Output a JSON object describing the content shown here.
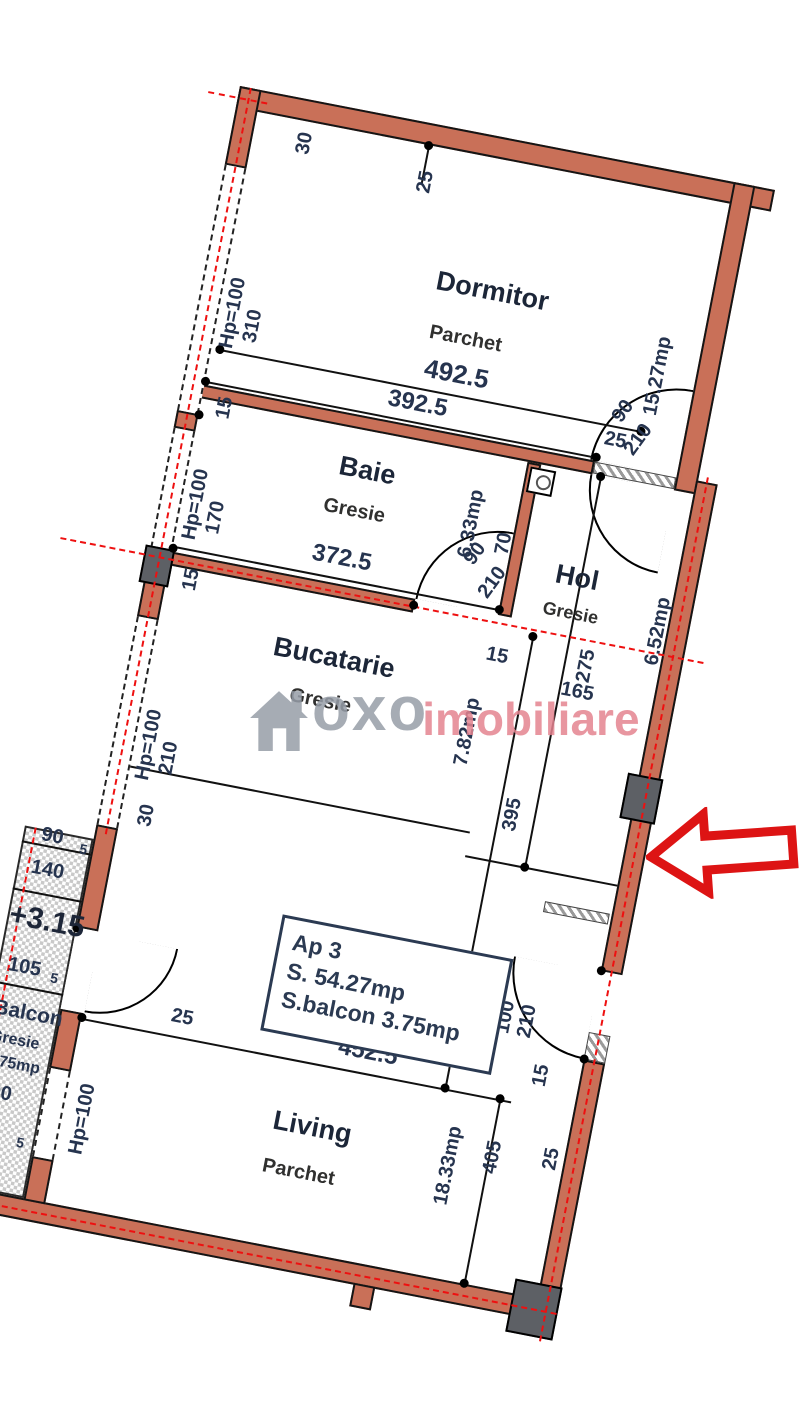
{
  "watermark": {
    "brand": "oxo",
    "suffix": "imobiliare"
  },
  "info_box": {
    "apartment": "Ap 3",
    "surface": "S.  54.27mp",
    "balcony_surface": "S.balcon  3.75mp"
  },
  "rooms": {
    "dormitor": {
      "name": "Dormitor",
      "floor": "Parchet",
      "area": "15.27mp"
    },
    "baie": {
      "name": "Baie",
      "floor": "Gresie",
      "area": "6.33mp"
    },
    "hol": {
      "name": "Hol",
      "floor": "Gresie",
      "area": "6.52mp"
    },
    "bucatarie": {
      "name": "Bucatarie",
      "floor": "Gresie",
      "area": "7.82mp"
    },
    "living": {
      "name": "Living",
      "floor": "Parchet",
      "area": "18.33mp"
    },
    "balcon": {
      "name": "Balcon",
      "floor": "Gresie",
      "area": "3.75mp"
    }
  },
  "dims": {
    "top_30": "30",
    "top_25": "25",
    "hp_dormitor": "Hp=100",
    "h_310": "310",
    "w_4925": "492.5",
    "w_3925": "392.5",
    "t_15a": "15",
    "t_25b": "25",
    "door_a_w": "90",
    "door_a_h": "210",
    "hp_baie": "Hp=100",
    "h_170": "170",
    "t_70": "70",
    "door_b_w": "90",
    "door_b_h": "210",
    "w_3725": "372.5",
    "t_15b": "15",
    "t_15c": "15",
    "w_165": "165",
    "h_275": "275",
    "h_395": "395",
    "hp_bucatarie": "Hp=100",
    "h_210": "210",
    "t_30b": "30",
    "door_e_w": "100",
    "door_e_h": "210",
    "t_15d": "15",
    "b_90a": "90",
    "b_5a": "5",
    "b_140": "140",
    "level": "+3.15",
    "b_105": "105",
    "b_5b": "5",
    "t_25c": "25",
    "w_4525": "452.5",
    "h_405": "405",
    "t_25d": "25",
    "hp_living": "Hp=100",
    "b_90b": "90",
    "b_5c": "5"
  },
  "colors": {
    "wall": "#c97058",
    "axis": "#ee1010",
    "arrow": "#dd1414",
    "text": "#26344f",
    "watermark_gray": "#979ea8",
    "watermark_pink": "#e58490"
  }
}
